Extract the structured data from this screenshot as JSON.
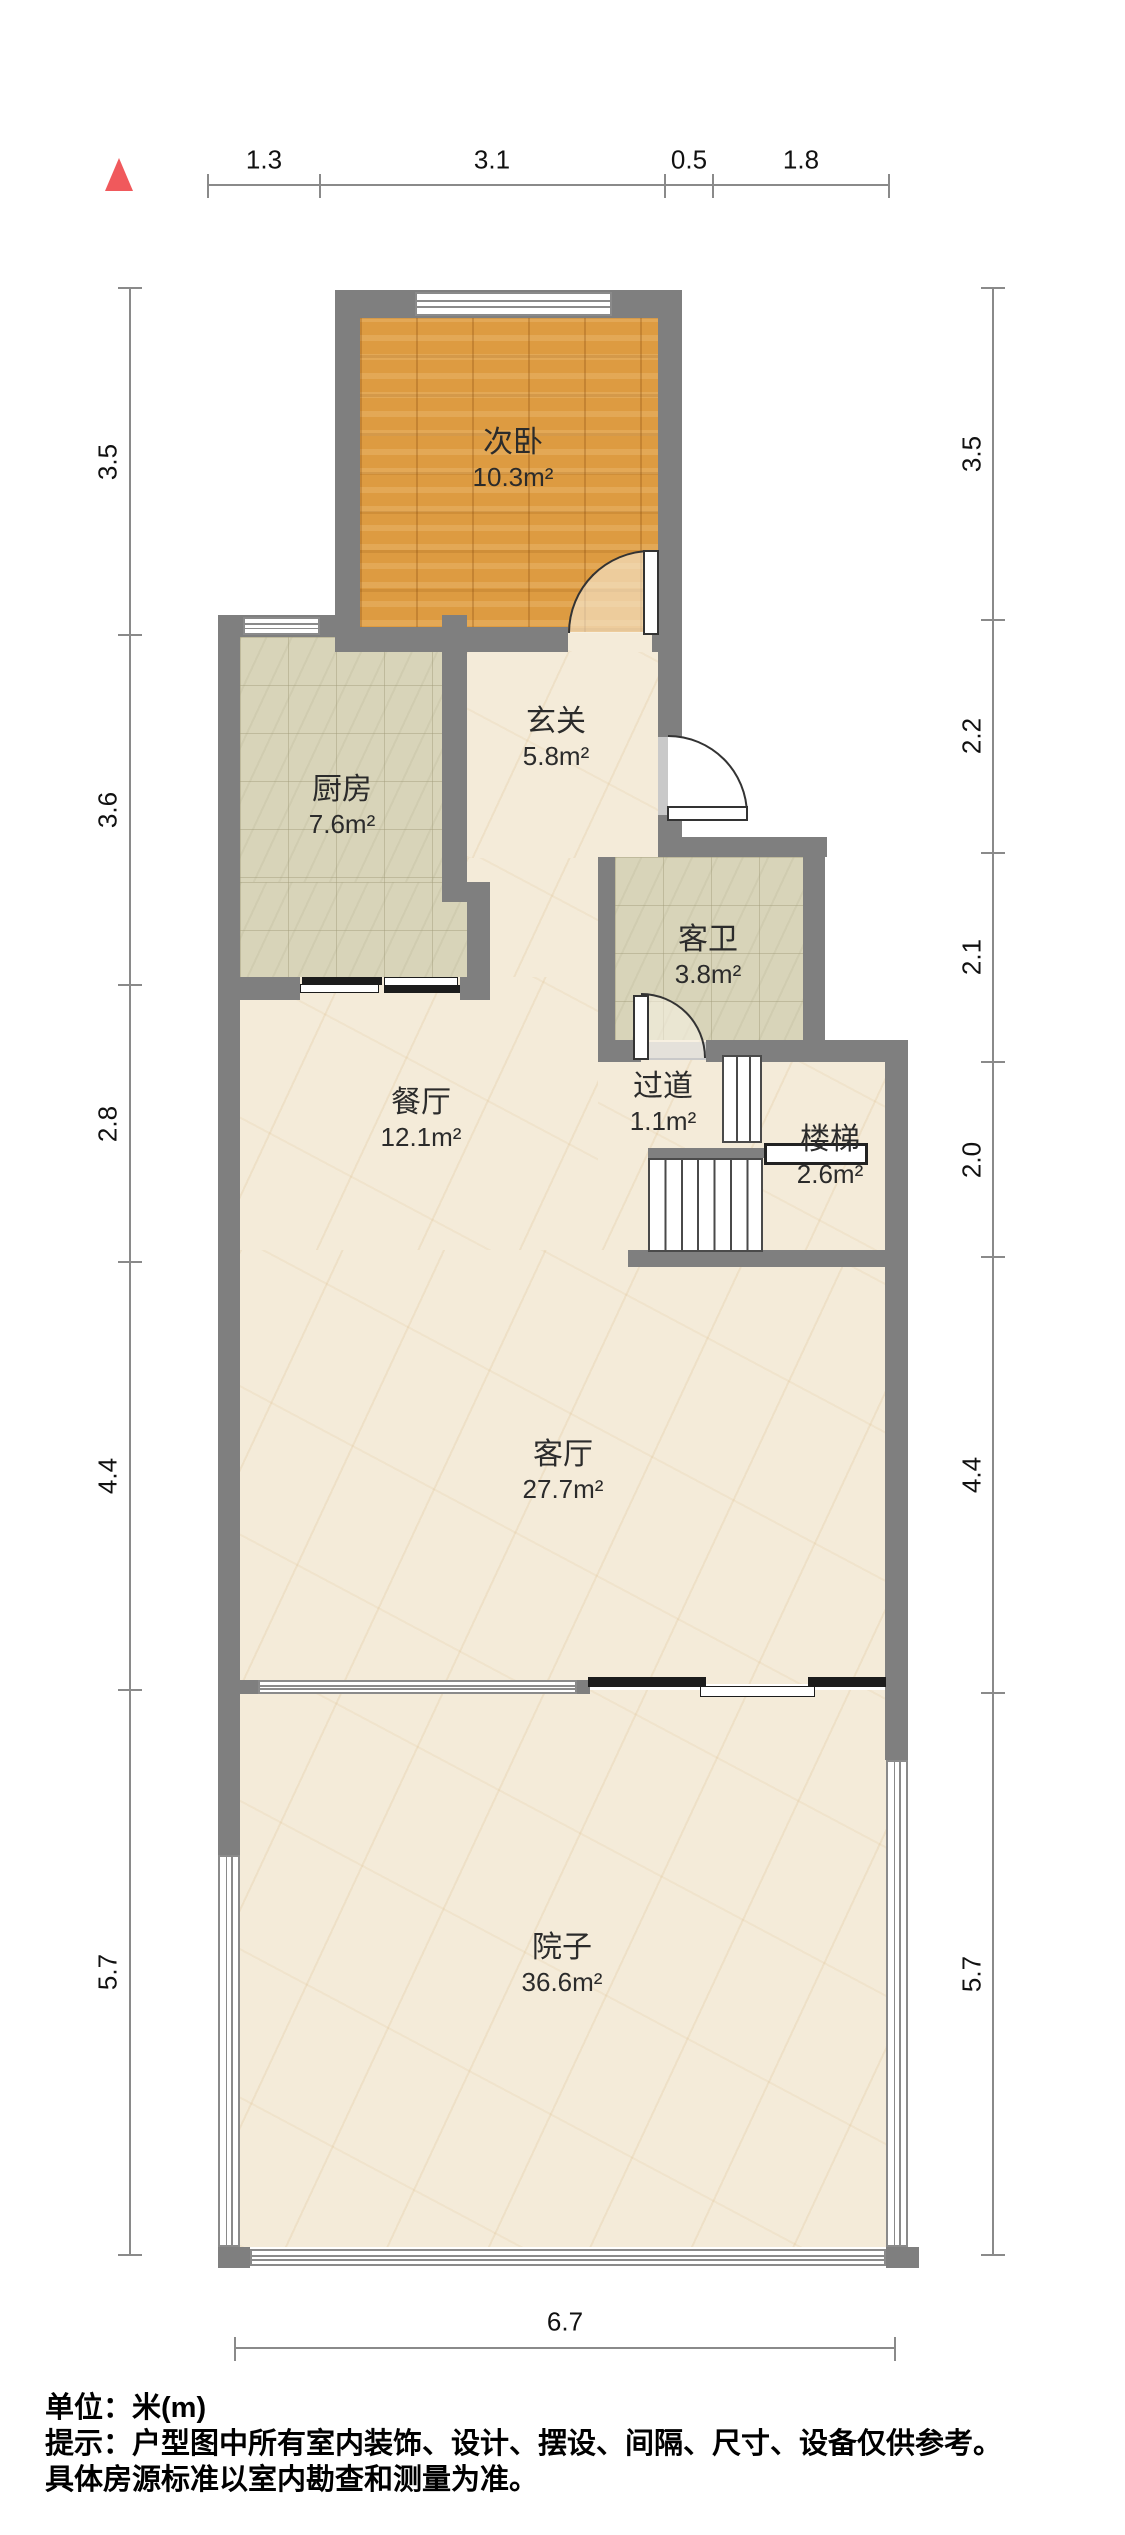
{
  "compass": {
    "name": "north-arrow",
    "color": "#f0595c"
  },
  "rooms": [
    {
      "name": "次卧",
      "area": "10.3m²"
    },
    {
      "name": "厨房",
      "area": "7.6m²"
    },
    {
      "name": "玄关",
      "area": "5.8m²"
    },
    {
      "name": "客卫",
      "area": "3.8m²"
    },
    {
      "name": "餐厅",
      "area": "12.1m²"
    },
    {
      "name": "过道",
      "area": "1.1m²"
    },
    {
      "name": "楼梯",
      "area": "2.6m²"
    },
    {
      "name": "客厅",
      "area": "27.7m²"
    },
    {
      "name": "院子",
      "area": "36.6m²"
    }
  ],
  "dimensions": {
    "top": [
      "1.3",
      "3.1",
      "0.5",
      "1.8"
    ],
    "left": [
      "3.5",
      "3.6",
      "2.8",
      "4.4",
      "5.7"
    ],
    "right": [
      "3.5",
      "2.2",
      "2.1",
      "2.0",
      "4.4",
      "5.7"
    ],
    "bottom": [
      "6.7"
    ]
  },
  "footer": {
    "unit": "单位：米(m)",
    "tip1": "提示：户型图中所有室内装饰、设计、摆设、间隔、尺寸、设备仅供参考。",
    "tip2": "具体房源标准以室内勘查和测量为准。"
  },
  "colors": {
    "wall": "#7f7f7f",
    "wood_floor": "#dd9b41",
    "tile_floor": "#d8d4b9",
    "marble_floor": "#f4ebd9",
    "north_arrow": "#f0595c"
  }
}
